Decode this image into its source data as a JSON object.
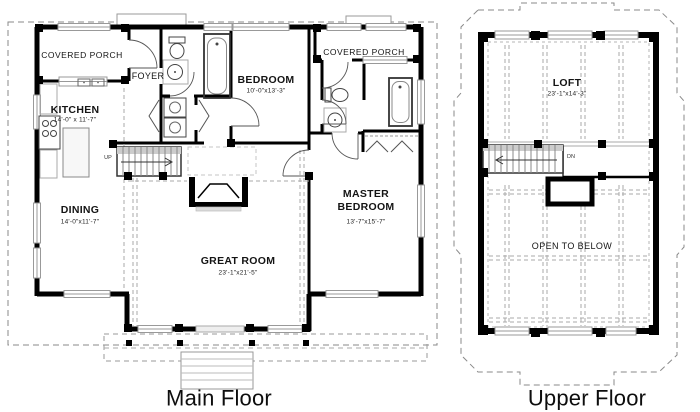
{
  "colors": {
    "walls": "#000000",
    "dashed": "#999999",
    "light_gray": "#bbbbbb"
  },
  "main_floor": {
    "caption": "Main Floor",
    "stairs_label": "UP",
    "rooms": {
      "covered_porch_left": {
        "name": "COVERED PORCH"
      },
      "foyer": {
        "name": "FOYER"
      },
      "kitchen": {
        "name": "KITCHEN",
        "dims": "14'-0\" x 11'-7\""
      },
      "bedroom": {
        "name": "BEDROOM",
        "dims": "10'-0\"x13'-3\""
      },
      "covered_porch_right": {
        "name": "COVERED PORCH"
      },
      "dining": {
        "name": "DINING",
        "dims": "14'-0\"x11'-7\""
      },
      "great_room": {
        "name": "GREAT ROOM",
        "dims": "23'-1\"x21'-5\""
      },
      "master_bedroom": {
        "name": "MASTER BEDROOM",
        "dims": "13'-7\"x15'-7\""
      }
    }
  },
  "upper_floor": {
    "caption": "Upper Floor",
    "stairs_label": "DN",
    "rooms": {
      "loft": {
        "name": "LOFT",
        "dims": "23'-1\"x14'-3\""
      },
      "open_to_below": {
        "name": "OPEN TO BELOW"
      }
    }
  }
}
